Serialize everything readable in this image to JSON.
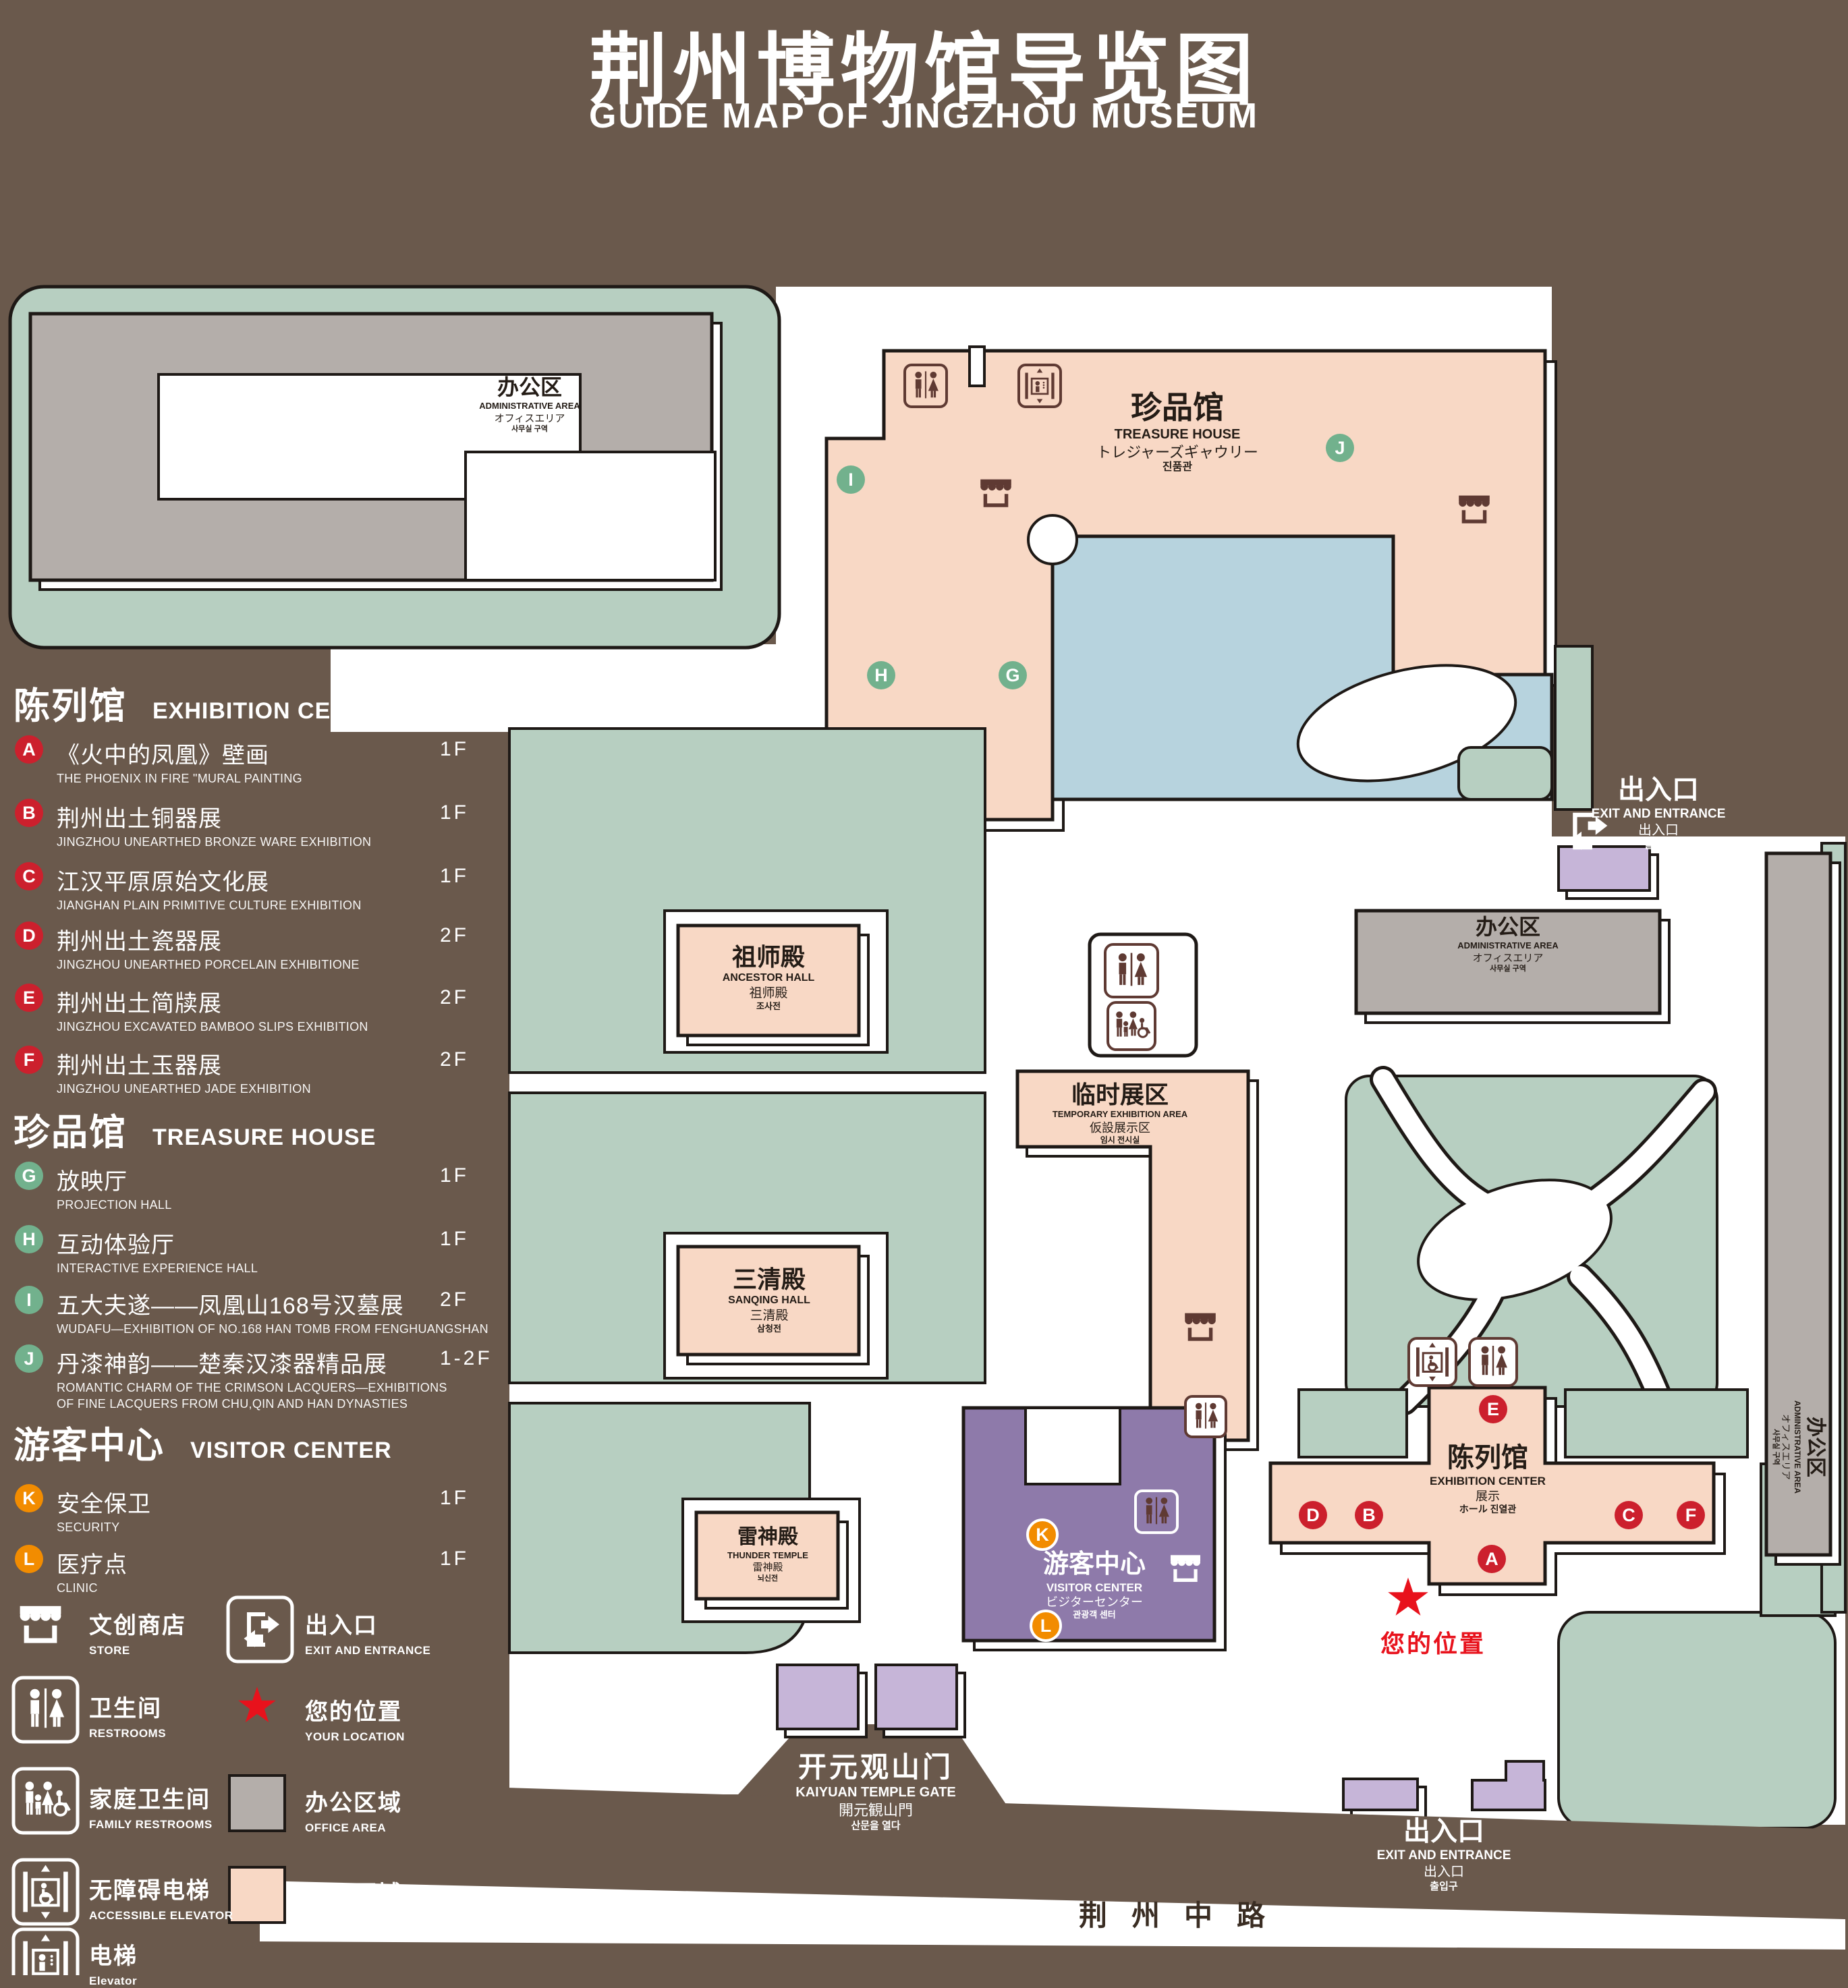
{
  "title": {
    "zh": "荆州博物馆导览图",
    "en": "GUIDE MAP OF JINGZHOU MUSEUM"
  },
  "palette": {
    "background": "#6a594c",
    "sage_green": "#b7cfc1",
    "display_pink": "#f8d8c5",
    "office_gray": "#b4aeaa",
    "pond_blue": "#b7d3de",
    "visitor_purple": "#8e7aaa",
    "gate_lavender": "#c6b5d8",
    "marker_red": "#cc202d",
    "marker_green": "#72b18d",
    "marker_orange": "#f28c00",
    "icon_maroon": "#5f3a33",
    "location_red": "#e8121c"
  },
  "legend": {
    "sections": [
      {
        "zh": "陈列馆",
        "en": "EXHIBITION CENTER",
        "items": [
          {
            "letter": "A",
            "zh": "《火中的凤凰》壁画",
            "en": "THE PHOENIX IN FIRE \"MURAL PAINTING",
            "floor": "1F"
          },
          {
            "letter": "B",
            "zh": "荆州出土铜器展",
            "en": "JINGZHOU UNEARTHED BRONZE WARE EXHIBITION",
            "floor": "1F"
          },
          {
            "letter": "C",
            "zh": "江汉平原原始文化展",
            "en": "JIANGHAN PLAIN PRIMITIVE CULTURE EXHIBITION",
            "floor": "1F"
          },
          {
            "letter": "D",
            "zh": "荆州出土瓷器展",
            "en": "JINGZHOU UNEARTHED PORCELAIN EXHIBITIONE",
            "floor": "2F"
          },
          {
            "letter": "E",
            "zh": "荆州出土简牍展",
            "en": "JINGZHOU EXCAVATED BAMBOO SLIPS EXHIBITION",
            "floor": "2F"
          },
          {
            "letter": "F",
            "zh": "荆州出土玉器展",
            "en": "JINGZHOU UNEARTHED JADE EXHIBITION",
            "floor": "2F"
          }
        ]
      },
      {
        "zh": "珍品馆",
        "en": "TREASURE HOUSE",
        "items": [
          {
            "letter": "G",
            "zh": "放映厅",
            "en": "PROJECTION HALL",
            "floor": "1F"
          },
          {
            "letter": "H",
            "zh": "互动体验厅",
            "en": "INTERACTIVE EXPERIENCE HALL",
            "floor": "1F"
          },
          {
            "letter": "I",
            "zh": "五大夫遂——凤凰山168号汉墓展",
            "en": "WUDAFU—EXHIBITION OF NO.168 HAN TOMB FROM FENGHUANGSHAN",
            "floor": "2F"
          },
          {
            "letter": "J",
            "zh": "丹漆神韵——楚秦汉漆器精品展",
            "en": "ROMANTIC CHARM OF THE CRIMSON LACQUERS—EXHIBITIONS",
            "en2": "OF FINE LACQUERS FROM CHU,QIN AND HAN DYNASTIES",
            "floor": "1-2F"
          }
        ]
      },
      {
        "zh": "游客中心",
        "en": "VISITOR CENTER",
        "items": [
          {
            "letter": "K",
            "zh": "安全保卫",
            "en": "SECURITY",
            "floor": "1F"
          },
          {
            "letter": "L",
            "zh": "医疗点",
            "en": "CLINIC",
            "floor": "1F"
          }
        ]
      }
    ],
    "facilities": {
      "col1": [
        {
          "icon": "store-icon",
          "zh": "文创商店",
          "en": "STORE"
        },
        {
          "icon": "restrooms-icon",
          "zh": "卫生间",
          "en": "RESTROOMS"
        },
        {
          "icon": "family-restrooms-icon",
          "zh": "家庭卫生间",
          "en": "FAMILY RESTROOMS"
        },
        {
          "icon": "accessible-elevator-icon",
          "zh": "无障碍电梯",
          "en": "ACCESSIBLE ELEVATOR"
        },
        {
          "icon": "elevator-icon",
          "zh": "电梯",
          "en": "Elevator"
        }
      ],
      "col2": [
        {
          "icon": "exit-icon",
          "zh": "出入口",
          "en": "EXIT AND ENTRANCE"
        },
        {
          "icon": "your-location-star",
          "zh": "您的位置",
          "en": "YOUR LOCATION"
        },
        {
          "icon": "office-area-swatch",
          "zh": "办公区域",
          "en": "OFFICE AREA"
        },
        {
          "icon": "display-area-swatch",
          "zh": "展示区域",
          "en": "DISPLAY AREA"
        }
      ]
    }
  },
  "map": {
    "buildings": {
      "admin": {
        "zh": "办公区",
        "en": "ADMINISTRATIVE AREA",
        "ja": "オフィスエリア",
        "ko": "사무실 구역"
      },
      "treasure": {
        "zh": "珍品馆",
        "en": "TREASURE HOUSE",
        "ja": "トレジャーズギャウリー",
        "ko": "진품관"
      },
      "ancestor": {
        "zh": "祖师殿",
        "en": "ANCESTOR HALL",
        "ja": "祖师殿",
        "ko": "조사전"
      },
      "temporary": {
        "zh": "临时展区",
        "en": "TEMPORARY EXHIBITION AREA",
        "ja": "仮設展示区",
        "ko": "임시 전시실"
      },
      "sanqing": {
        "zh": "三清殿",
        "en": "SANQING HALL",
        "ja": "三清殿",
        "ko": "삼청전"
      },
      "thunder": {
        "zh": "雷神殿",
        "en": "THUNDER TEMPLE",
        "ja": "雷神殿",
        "ko": "뇌신전"
      },
      "visitor": {
        "zh": "游客中心",
        "en": "VISITOR CENTER",
        "ja": "ビジターセンター",
        "ko": "관광객 센터"
      },
      "exhibition": {
        "zh": "陈列馆",
        "en": "EXHIBITION CENTER",
        "ja": "展示",
        "ko": "ホール 진열관"
      },
      "exit": {
        "zh": "出入口",
        "en": "EXIT AND ENTRANCE",
        "ja": "出入口",
        "ko": "출입구"
      },
      "gate": {
        "zh": "开元观山门",
        "en": "KAIYUAN TEMPLE GATE",
        "ja": "開元観山門",
        "ko": "산문을 열다"
      },
      "road": {
        "zh": "荆州中路"
      },
      "your_location": {
        "zh": "您的位置"
      }
    },
    "markers": {
      "a": "A",
      "b": "B",
      "c": "C",
      "d": "D",
      "e": "E",
      "f": "F",
      "g": "G",
      "h": "H",
      "i": "I",
      "j": "J",
      "k": "K",
      "l": "L"
    }
  }
}
